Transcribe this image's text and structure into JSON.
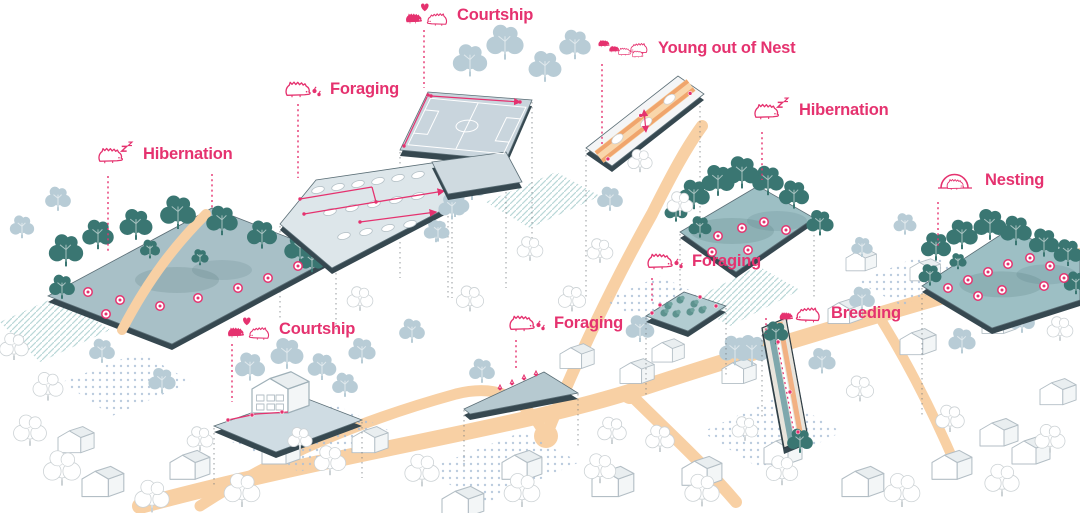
{
  "diagram": {
    "subject": "Hedgehog habitat activities over an axonometric neighbourhood",
    "colors": {
      "accent_pink": "#e5326f",
      "tree_teal": "#4f8c87",
      "tree_teal_dark": "#3a7672",
      "platform_teal": "#9dbfc4",
      "platform_gray": "#dde6ea",
      "road_orange": "#f8d0a4",
      "stripe_orange": "#f0a56c",
      "edge_dark": "#364850",
      "bg_tree_blue": "#b8ccd6",
      "background": "#ffffff"
    }
  },
  "annotations": [
    {
      "label": "Hibernation",
      "icon": "hedgehog-sleeping-icon"
    },
    {
      "label": "Foraging",
      "icon": "hedgehog-foraging-icon"
    },
    {
      "label": "Courtship",
      "icon": "hedgehog-courtship-icon"
    },
    {
      "label": "Young out of Nest",
      "icon": "hedgehog-family-icon"
    },
    {
      "label": "Hibernation",
      "icon": "hedgehog-sleeping-icon"
    },
    {
      "label": "Nesting",
      "icon": "hedgehog-nesting-icon"
    },
    {
      "label": "Foraging",
      "icon": "hedgehog-foraging-icon"
    },
    {
      "label": "Foraging",
      "icon": "hedgehog-foraging-icon"
    },
    {
      "label": "Breeding",
      "icon": "hedgehog-breeding-icon"
    },
    {
      "label": "Courtship",
      "icon": "hedgehog-courtship-icon"
    }
  ],
  "scene": {
    "roads": [
      {
        "d": "M140,506 C340,452 520,428 642,388 C800,336 952,294 1080,256",
        "w": 16
      },
      {
        "d": "M546,436 C576,360 616,278 652,214 C672,174 686,148 702,126",
        "w": 12
      },
      {
        "d": "M630,394 C666,430 700,460 736,502",
        "w": 12
      },
      {
        "d": "M200,506 C280,454 362,420 456,394 C492,385 522,392 546,436",
        "w": 11
      },
      {
        "d": "M880,318 C906,360 932,410 956,466",
        "w": 10
      }
    ],
    "dot_patches": [
      "232,442 330,402 392,432 300,472",
      "604,300 660,276 702,296 644,322",
      "424,470 522,432 580,462 484,504",
      "702,432 780,396 842,432 762,470",
      "62,382 140,352 192,382 112,416",
      "858,282 928,252 970,276 902,306"
    ],
    "hatch_patches": [
      "688,302 758,266 800,290 730,326",
      "0,322 58,296 110,330 40,362",
      "486,202 556,172 600,196 530,228"
    ],
    "bg_trees": [
      [
        470,
        62,
        1.2
      ],
      [
        505,
        44,
        1.3
      ],
      [
        545,
        68,
        1.15
      ],
      [
        575,
        46,
        1.1
      ],
      [
        610,
        200,
        0.9
      ],
      [
        640,
        330,
        1.0
      ],
      [
        700,
        312,
        0.95
      ],
      [
        752,
        352,
        1.15
      ],
      [
        822,
        362,
        0.95
      ],
      [
        862,
        300,
        0.9
      ],
      [
        962,
        342,
        0.95
      ],
      [
        1022,
        322,
        0.9
      ],
      [
        362,
        352,
        0.95
      ],
      [
        412,
        332,
        0.9
      ],
      [
        162,
        382,
        0.95
      ],
      [
        102,
        352,
        0.9
      ],
      [
        250,
        368,
        1.05
      ],
      [
        287,
        355,
        1.15
      ],
      [
        322,
        368,
        1.0
      ],
      [
        345,
        386,
        0.9
      ],
      [
        455,
        205,
        1.0
      ],
      [
        478,
        176,
        1.05
      ],
      [
        436,
        232,
        0.85
      ],
      [
        735,
        352,
        1.1
      ],
      [
        58,
        200,
        0.9
      ],
      [
        22,
        228,
        0.85
      ],
      [
        905,
        225,
        0.8
      ],
      [
        862,
        248,
        0.75
      ],
      [
        482,
        372,
        0.9
      ]
    ],
    "white_trees": [
      [
        62,
        470,
        1.3
      ],
      [
        152,
        498,
        1.2
      ],
      [
        242,
        492,
        1.25
      ],
      [
        330,
        462,
        1.1
      ],
      [
        422,
        472,
        1.2
      ],
      [
        522,
        492,
        1.25
      ],
      [
        612,
        432,
        1.0
      ],
      [
        702,
        492,
        1.2
      ],
      [
        782,
        472,
        1.1
      ],
      [
        902,
        492,
        1.25
      ],
      [
        1002,
        482,
        1.2
      ],
      [
        30,
        432,
        1.15
      ],
      [
        572,
        300,
        0.95
      ],
      [
        530,
        250,
        0.9
      ],
      [
        470,
        300,
        0.95
      ],
      [
        600,
        470,
        1.1
      ],
      [
        950,
        420,
        1.0
      ],
      [
        1050,
        440,
        1.05
      ],
      [
        860,
        390,
        0.95
      ],
      [
        680,
        205,
        0.9
      ],
      [
        640,
        162,
        0.85
      ],
      [
        600,
        252,
        0.9
      ],
      [
        14,
        348,
        1.0
      ],
      [
        48,
        388,
        1.05
      ],
      [
        300,
        440,
        0.85
      ],
      [
        360,
        300,
        0.9
      ],
      [
        200,
        440,
        0.9
      ],
      [
        660,
        440,
        1.0
      ],
      [
        745,
        430,
        0.9
      ],
      [
        1060,
        330,
        0.9
      ]
    ],
    "houses": [
      [
        82,
        468,
        1.1
      ],
      [
        170,
        452,
        1.05
      ],
      [
        262,
        438,
        1.0
      ],
      [
        352,
        428,
        0.95
      ],
      [
        502,
        452,
        1.05
      ],
      [
        592,
        468,
        1.1
      ],
      [
        682,
        458,
        1.05
      ],
      [
        764,
        438,
        1.0
      ],
      [
        842,
        468,
        1.1
      ],
      [
        932,
        452,
        1.05
      ],
      [
        1012,
        438,
        1.0
      ],
      [
        58,
        428,
        0.95
      ],
      [
        442,
        488,
        1.1
      ],
      [
        828,
        300,
        0.9
      ],
      [
        900,
        330,
        0.95
      ],
      [
        982,
        310,
        0.9
      ],
      [
        722,
        360,
        0.9
      ],
      [
        652,
        340,
        0.85
      ],
      [
        910,
        260,
        0.8
      ],
      [
        846,
        250,
        0.8
      ],
      [
        1040,
        380,
        0.95
      ],
      [
        980,
        420,
        1.0
      ],
      [
        560,
        345,
        0.9
      ],
      [
        620,
        360,
        0.9
      ]
    ],
    "drop_lines": [
      [
        336,
        258,
        330
      ],
      [
        280,
        226,
        318
      ],
      [
        452,
        162,
        298
      ],
      [
        400,
        152,
        278
      ],
      [
        532,
        102,
        238
      ],
      [
        448,
        196,
        298
      ],
      [
        506,
        162,
        288
      ],
      [
        586,
        150,
        298
      ],
      [
        700,
        96,
        228
      ],
      [
        680,
        234,
        328
      ],
      [
        814,
        220,
        298
      ],
      [
        922,
        288,
        418
      ],
      [
        1008,
        232,
        328
      ],
      [
        646,
        318,
        398
      ],
      [
        726,
        308,
        378
      ],
      [
        464,
        410,
        468
      ],
      [
        578,
        394,
        448
      ],
      [
        214,
        428,
        488
      ],
      [
        362,
        422,
        478
      ],
      [
        762,
        330,
        420
      ]
    ],
    "leaders": [
      [
        108,
        176,
        252
      ],
      [
        212,
        174,
        208
      ],
      [
        298,
        104,
        178
      ],
      [
        424,
        30,
        88
      ],
      [
        602,
        64,
        144
      ],
      [
        762,
        132,
        180
      ],
      [
        938,
        202,
        248
      ],
      [
        652,
        278,
        302
      ],
      [
        516,
        340,
        370
      ],
      [
        766,
        318,
        334
      ],
      [
        232,
        344,
        402
      ]
    ],
    "platforms": [
      {
        "id": "hibernation-left",
        "pts": "48,296 212,208 336,256 172,344",
        "fill": "#a8c0c7",
        "path": {
          "d": "M206,214 C178,242 150,276 122,330",
          "w": 10
        },
        "trees": [
          [
            66,
            252,
            1.2
          ],
          [
            98,
            236,
            1.1
          ],
          [
            136,
            226,
            1.15
          ],
          [
            178,
            214,
            1.25
          ],
          [
            222,
            222,
            1.1
          ],
          [
            262,
            236,
            1.05
          ],
          [
            300,
            250,
            1.1
          ],
          [
            62,
            288,
            0.9
          ],
          [
            312,
            262,
            0.85
          ],
          [
            150,
            250,
            0.7
          ],
          [
            200,
            258,
            0.6
          ]
        ],
        "markers": [
          [
            88,
            292
          ],
          [
            120,
            300
          ],
          [
            160,
            306
          ],
          [
            198,
            298
          ],
          [
            238,
            288
          ],
          [
            268,
            278
          ],
          [
            298,
            266
          ],
          [
            106,
            314
          ]
        ]
      },
      {
        "id": "foraging-parking",
        "pts": "280,224 316,180 452,160 458,202 332,268",
        "fill": "#dde6ea",
        "cars": [
          [
            318,
            190
          ],
          [
            338,
            187
          ],
          [
            358,
            184
          ],
          [
            378,
            181
          ],
          [
            398,
            178
          ],
          [
            418,
            175
          ],
          [
            330,
            212
          ],
          [
            352,
            208
          ],
          [
            374,
            204
          ],
          [
            396,
            200
          ],
          [
            418,
            196
          ],
          [
            344,
            236
          ],
          [
            366,
            232
          ],
          [
            388,
            228
          ],
          [
            410,
            224
          ]
        ],
        "route": [
          {
            "d": "M300,199 L372,187",
            "arrow": false
          },
          {
            "d": "M372,187 L376,202",
            "arrow": false
          },
          {
            "d": "M376,202 L304,214",
            "arrow": false
          },
          {
            "d": "M376,202 L444,191",
            "arrow": true
          },
          {
            "d": "M360,222 L436,212",
            "arrow": true
          }
        ],
        "squares": [
          [
            300,
            199
          ],
          [
            376,
            202
          ],
          [
            304,
            214
          ],
          [
            360,
            222
          ]
        ],
        "trees_bg": [
          [
            452,
            208,
            0.95
          ],
          [
            472,
            188,
            1.0
          ],
          [
            438,
            232,
            0.8
          ]
        ]
      },
      {
        "id": "courtship-field",
        "pts": "400,150 428,92 532,100 506,160",
        "fill": "#c9d5dd",
        "pts2": "432,162 506,152 522,182 448,194",
        "squares": [
          [
            404,
            146
          ],
          [
            428,
            95
          ],
          [
            431,
            96
          ],
          [
            520,
            102
          ]
        ]
      },
      {
        "id": "young-strip",
        "pts": "586,148 678,76 704,94 612,166",
        "fill": "#f4f5f6"
      },
      {
        "id": "hibernation-right",
        "pts": "680,232 758,186 814,218 736,272",
        "fill": "#9dbfc4",
        "trees": [
          [
            694,
            196,
            1.1
          ],
          [
            718,
            182,
            1.15
          ],
          [
            742,
            174,
            1.2
          ],
          [
            768,
            182,
            1.1
          ],
          [
            794,
            196,
            1.05
          ],
          [
            700,
            228,
            0.8
          ],
          [
            820,
            224,
            0.95
          ],
          [
            676,
            212,
            0.8
          ]
        ],
        "markers": [
          [
            718,
            236
          ],
          [
            742,
            228
          ],
          [
            764,
            222
          ],
          [
            786,
            230
          ],
          [
            712,
            252
          ],
          [
            748,
            250
          ]
        ]
      },
      {
        "id": "nesting",
        "pts": "922,286 1008,230 1080,258 1080,300 992,328",
        "fill": "#9dbfc4",
        "trees": [
          [
            936,
            248,
            1.05
          ],
          [
            962,
            236,
            1.1
          ],
          [
            990,
            226,
            1.15
          ],
          [
            1016,
            232,
            1.1
          ],
          [
            1044,
            244,
            1.05
          ],
          [
            1068,
            254,
            1.0
          ],
          [
            930,
            276,
            0.8
          ],
          [
            1076,
            284,
            0.85
          ],
          [
            958,
            262,
            0.6
          ]
        ],
        "markers": [
          [
            948,
            288
          ],
          [
            968,
            280
          ],
          [
            988,
            272
          ],
          [
            1008,
            264
          ],
          [
            1030,
            258
          ],
          [
            1050,
            266
          ],
          [
            978,
            296
          ],
          [
            1002,
            290
          ],
          [
            1044,
            286
          ],
          [
            1064,
            278
          ]
        ]
      },
      {
        "id": "foraging-square",
        "pts": "646,316 684,292 726,306 688,331",
        "fill": "#b2ccd1",
        "shrubs": [
          [
            668,
            306
          ],
          [
            680,
            300
          ],
          [
            694,
            304
          ],
          [
            676,
            314
          ],
          [
            690,
            312
          ],
          [
            702,
            310
          ],
          [
            664,
            313
          ]
        ],
        "markers_s": [
          [
            652,
            313
          ],
          [
            700,
            297
          ],
          [
            716,
            306
          ],
          [
            660,
            305
          ]
        ]
      },
      {
        "id": "foraging-wedge",
        "pts": "464,409 544,372 578,393 470,414",
        "fill": "#b6c9d0",
        "edge_items": [
          [
            500,
            389
          ],
          [
            512,
            384
          ],
          [
            524,
            379
          ],
          [
            536,
            375
          ]
        ]
      },
      {
        "id": "courtship-house",
        "pts": "214,426 300,396 362,420 276,452",
        "fill": "#cfdce3",
        "route": [
          {
            "d": "M228,420 L256,414 L288,412",
            "arrow": false
          }
        ],
        "markers_s": [
          [
            228,
            420
          ],
          [
            252,
            415
          ],
          [
            282,
            412
          ]
        ]
      },
      {
        "id": "breeding-strip",
        "pts": "762,328 786,318 808,438 784,448",
        "fill": "#e8e4dc",
        "trees": [
          [
            776,
            334,
            0.85
          ],
          [
            800,
            442,
            0.9
          ]
        ],
        "markers_s": [
          [
            778,
            342
          ],
          [
            790,
            392
          ],
          [
            798,
            432
          ]
        ]
      }
    ]
  }
}
